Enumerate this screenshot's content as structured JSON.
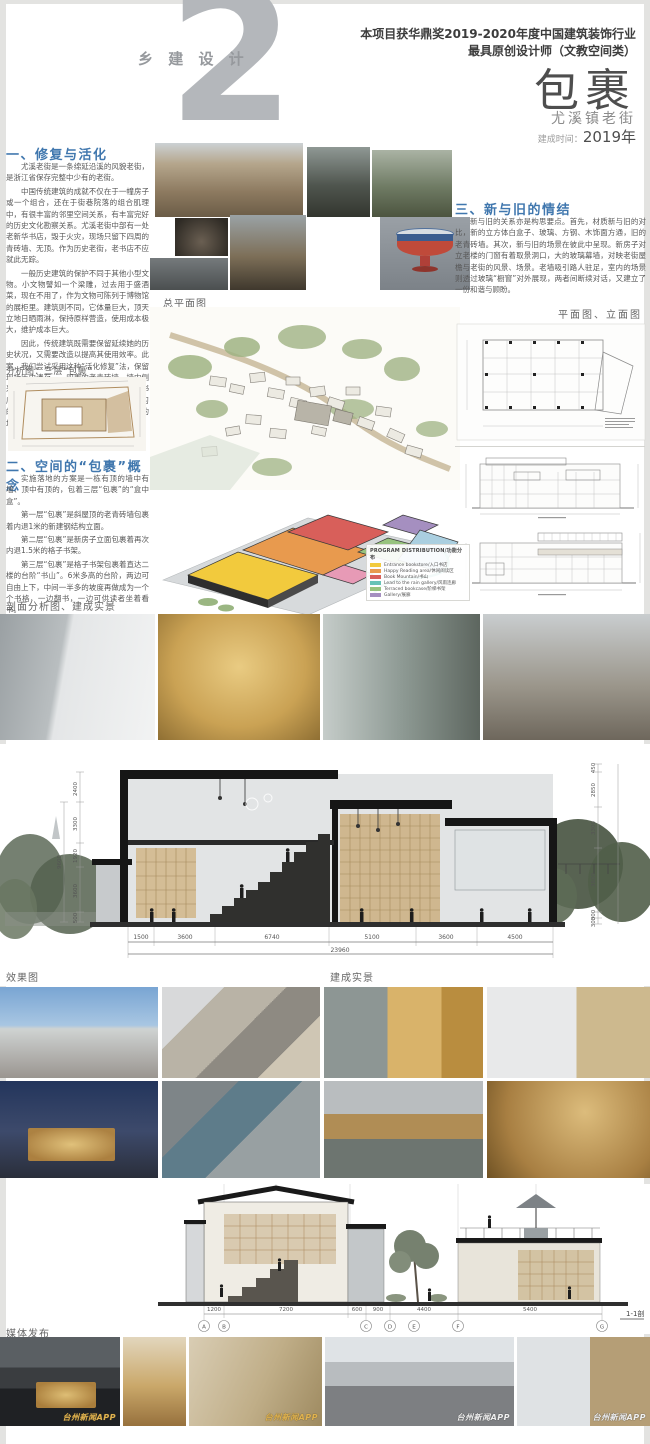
{
  "header": {
    "number": "2",
    "series": "乡 建 设 计",
    "award_line1": "本项目获华鼎奖2019-2020年度中国建筑装饰行业",
    "award_line2": "最具原创设计师（文教空间类）",
    "title": "包裹",
    "subtitle": "尤溪镇老街",
    "completion_label": "建成时间：",
    "completion_value": "2019年"
  },
  "left": {
    "s1_heading": "一、修复与活化",
    "s1_paras": [
      "尤溪老街是一条绵延沿溪的风貌老街，是浙江省保存完整中少有的老街。",
      "中国传统建筑的成就不仅在于一幢房子或一个组合，还在于街巷院落的组合肌理中，有很丰富的邻里空间关系，有丰富完好的历史文化勘察关系。尤溪老街中部有一处老新华书店，毁于火灾，现场只留下四周的青砖墙、无顶。作为历史老街，老书店不应就此无踪。",
      "一般历史建筑的保护不同于其他小型文物。小文物譬如一个梁雕，过去用于盛酒菜，现在不用了，作为文物可陈列于博物馆的展柜里。建筑则不同，它体量巨大，顶天立地日晒雨淋，保持原样营造，使用成本极大，维护成本巨大。",
      "因此，传统建筑既需要保留延续她的历史状况，又需要改造以提高其使用效率。此案，我们尝试采用这种“活化修复”法，保留现场历史遗存——四周的老青砖墙，墙内侧采用钢结构玻璃，新建空间作为临海书香书店尤溪分馆，成为一处公共阅读场所、学习的场地，也可作为小型讲座、小型分享会的场所。"
    ],
    "analysis_label": "分析图：三层“包裹”",
    "s2_heading": "二、空间的“包裹”概念",
    "s2_paras": [
      "实施落地的方案是一栋有顶的墙中有墙、顶中有顶的，包着三层“包裹”的“盒中盒”。",
      "第一层“包裹”是斜屋顶的老青砖墙包裹着内退1米的新建钢结构立面。",
      "第二层“包裹”是新房子立面包裹着再次内退1.5米的格子书架。",
      "第三层“包裹”是格子书架包裹着直达二楼的台阶“书山”。6米多高的台阶，两边可自由上下，中间一半多的坡度再做成为一个个书格，一边翻书，一边可供读者坐着看书。",
      "三层包裹带出了空间与通道，形成了空间的层层递进与迂回，让读者穿梭随意翻翻看看，营造了场所的互动与宁静、现实与隐喻、直白与含蓄。"
    ]
  },
  "right": {
    "s3_heading": "三、新与旧的情结",
    "s3_para": "新与旧的关系亦是构思要点。首先，材质新与旧的对比，新的立方体白盒子、玻璃、方钢、木饰面方通，旧的老青砖墙。其次，新与旧的场景在彼此中呈现。新房子对立老楼的门窗有着取景洞口，大的玻璃幕墙，对映老街屋檐与老街的风景、场景。老墙吸引路人驻足，室内的场景则透过玻璃“橱窗”对外展现，两者间断续对话，又建立了一份和谐与顾盼。",
    "plans_label": "平面图、立面图"
  },
  "labels": {
    "site_plan": "总平面图",
    "section_row": "剖面分析图、建成实景",
    "render": "效果图",
    "built": "建成实景",
    "media": "媒体发布"
  },
  "legend": {
    "title": "PROGRAM DISTRIBUTION/功能分布",
    "items": [
      {
        "color": "#f2ca3d",
        "label": "Entrance bookstore/入口书店"
      },
      {
        "color": "#e89a4e",
        "label": "Happy Reading area/休闲阅读区"
      },
      {
        "color": "#d85f5a",
        "label": "Book Mountain/书山"
      },
      {
        "color": "#67c3b7",
        "label": "Lead to the rain gallery/风雨连廊"
      },
      {
        "color": "#97c37e",
        "label": "Terraced bookcase/阶梯书架"
      },
      {
        "color": "#a58fc0",
        "label": "Gallery/展廊"
      }
    ]
  },
  "big_section": {
    "bottom_dims": [
      "1500",
      "3600",
      "6740",
      "5100",
      "3600",
      "4500"
    ],
    "bottom_total": "23960",
    "left_dims": [
      "2400",
      "3300",
      "1920",
      "3600",
      "500"
    ],
    "left_total": "9600",
    "right_dims": [
      "450",
      "2850",
      "3300",
      "3600",
      "300",
      "300"
    ]
  },
  "section2": {
    "dims": [
      "1200",
      "7200",
      "600",
      "900",
      "4400",
      "5400"
    ],
    "bubbles": [
      "A",
      "B",
      "C",
      "D",
      "E",
      "F",
      "G"
    ],
    "label": "1-1剖"
  },
  "media": {
    "watermark": "台州新闻APP"
  },
  "colors": {
    "heading_blue": "#4077ae",
    "number_gray": "#b4b7bb",
    "page_bg": "#e3e3e1"
  }
}
